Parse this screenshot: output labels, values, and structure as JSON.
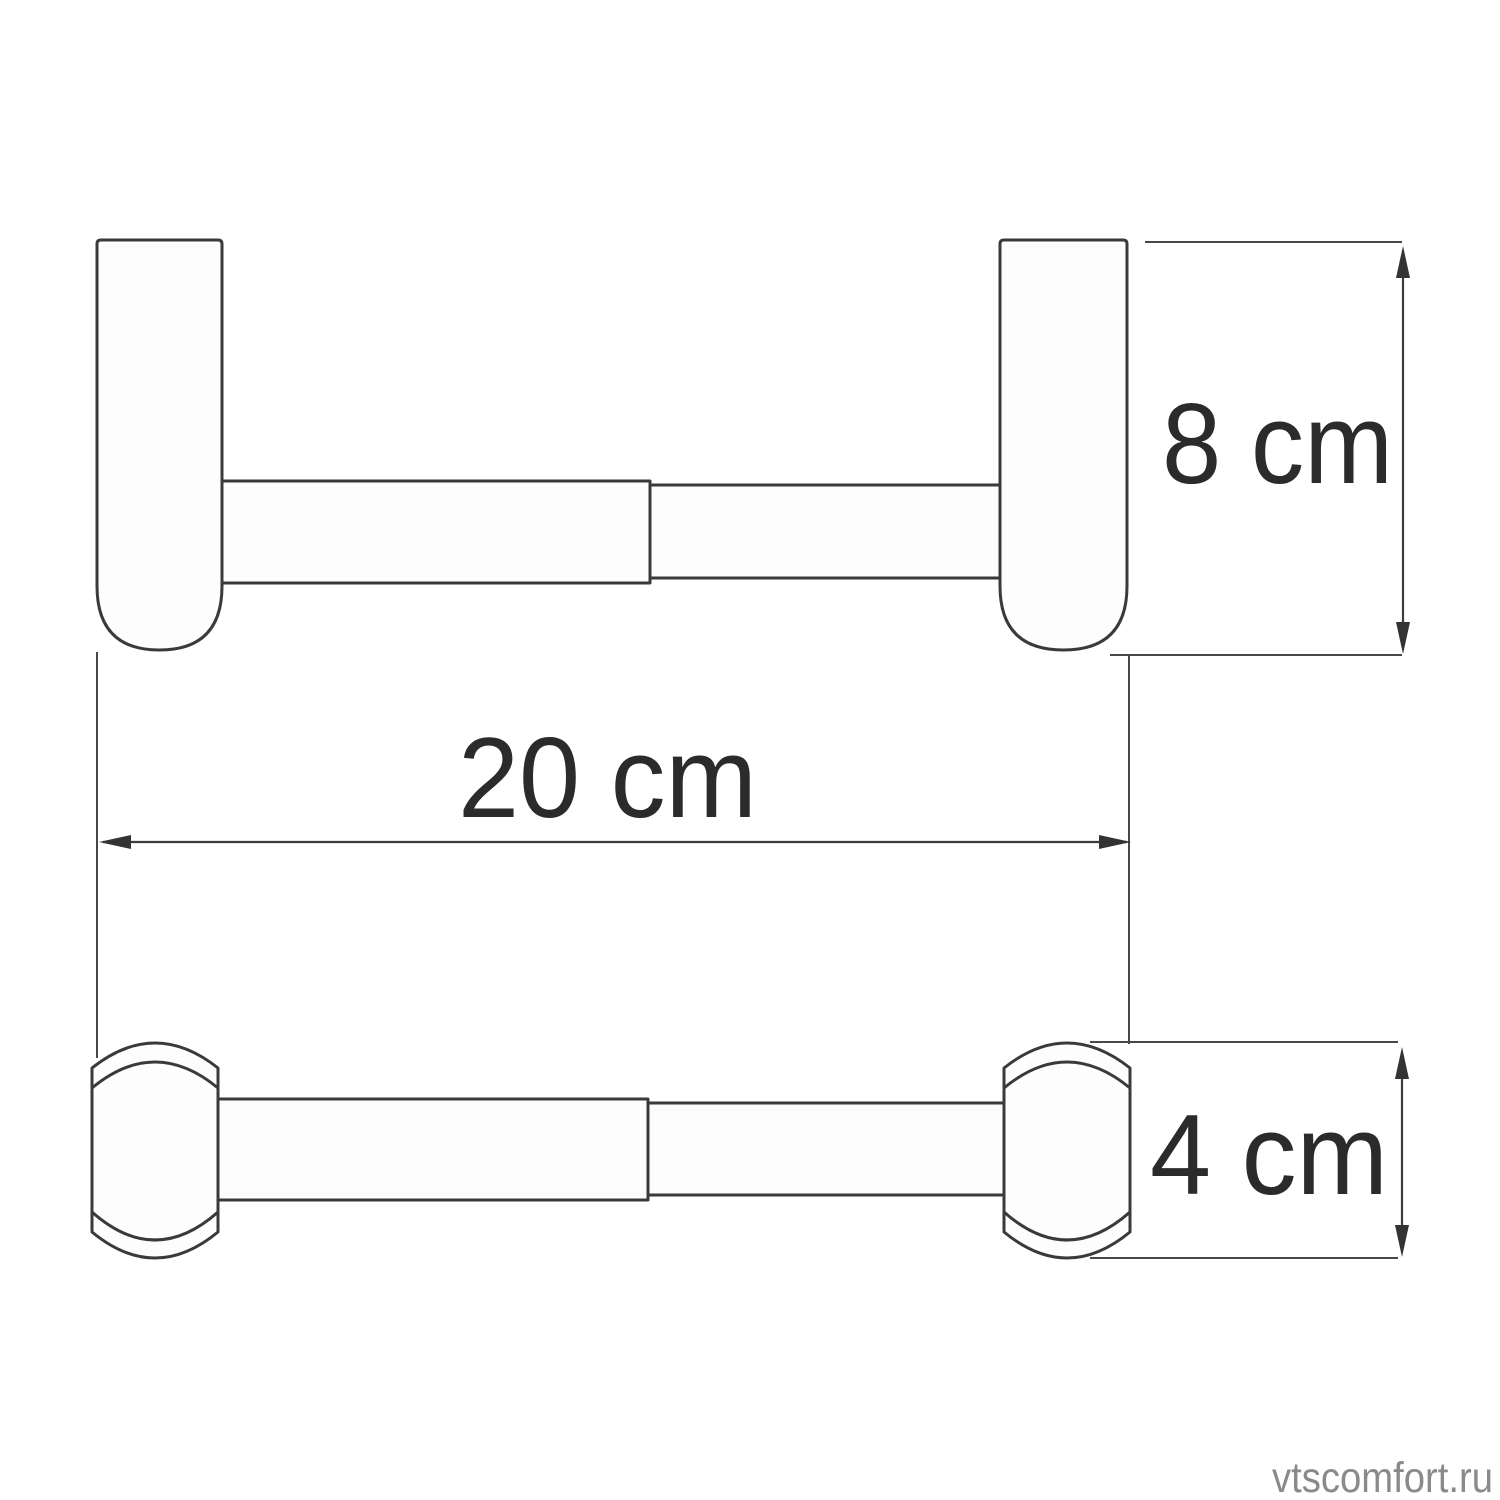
{
  "diagram": {
    "kind": "product-dimension-drawing",
    "dimensions": {
      "height_label": "8 cm",
      "width_label": "20 cm",
      "depth_label": "4 cm"
    },
    "colors": {
      "outline": "#3a3a3a",
      "label_text": "#2b2b2b",
      "watermark_text": "#8a8a8a",
      "background": "#ffffff",
      "shape_fill": "#fdfdfd"
    }
  },
  "watermark": {
    "text": "vtscomfort.ru"
  }
}
